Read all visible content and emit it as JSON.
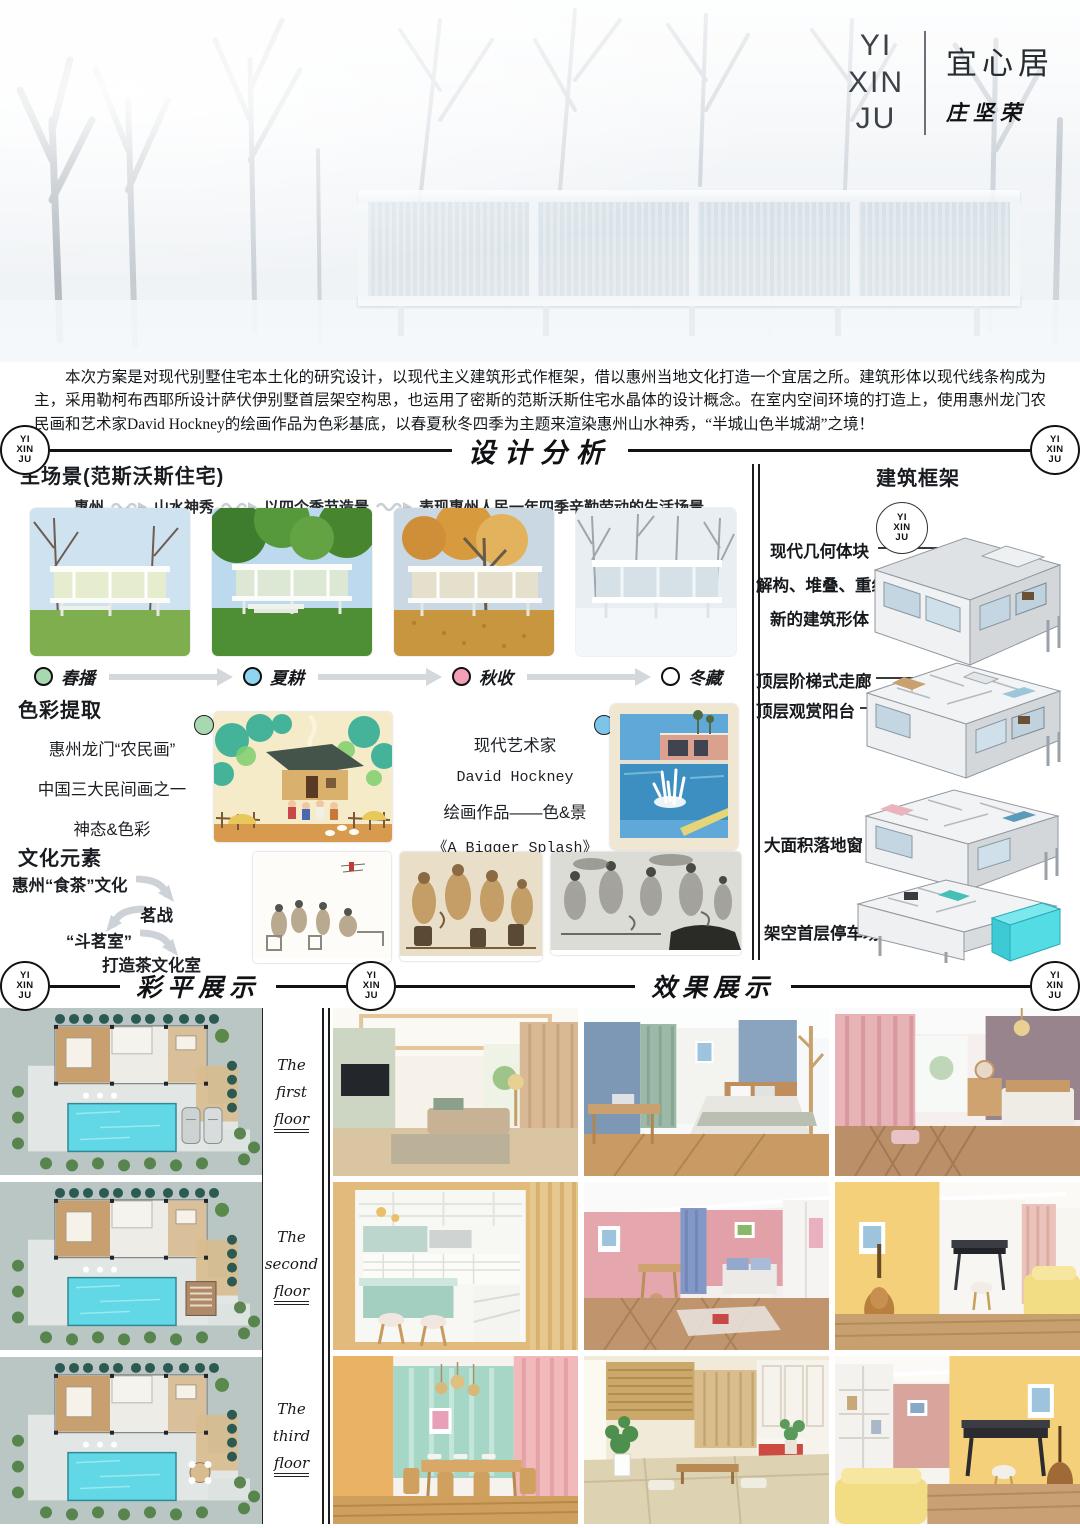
{
  "meta": {
    "logo": [
      "YI",
      "XIN",
      "JU"
    ],
    "title": "宜心居",
    "author": "庄坚荣"
  },
  "intro": {
    "text": "本次方案是对现代别墅住宅本土化的研究设计，以现代主义建筑形式作框架，借以惠州当地文化打造一个宜居之所。建筑形体以现代线条构成为主，采用勒柯布西耶所设计萨伏伊别墅首层架空构思，也运用了密斯的范斯沃斯住宅水晶体的设计概念。在室内空间环境的打造上，使用惠州龙门农民画和艺术家David Hockney的绘画作品为色彩基底，以春夏秋冬四季为主题来渲染惠州山水神秀，“半城山色半城湖”之境！"
  },
  "sections": {
    "analysis": "设计分析",
    "plans": "彩平展示",
    "renders": "效果展示"
  },
  "main_scene": {
    "heading": "主场景(范斯沃斯住宅)",
    "flow": [
      "惠州",
      "山水神秀",
      "以四个季节造景",
      "表现惠州人民一年四季辛勤劳动的生活场景"
    ],
    "seasons": [
      {
        "label": "春播",
        "color": "#a8d8b0"
      },
      {
        "label": "夏耕",
        "color": "#8fd4f0"
      },
      {
        "label": "秋收",
        "color": "#f2a0b8"
      },
      {
        "label": "冬藏",
        "color": "#ffffff"
      }
    ]
  },
  "color_extract": {
    "heading": "色彩提取",
    "folk": [
      "惠州龙门“农民画”",
      "中国三大民间画之一",
      "神态&色彩"
    ],
    "folk_dot_color": "#a8d8b0",
    "artist": [
      "现代艺术家",
      "David Hockney",
      "绘画作品——色&景",
      "《A Bigger Splash》"
    ],
    "artist_dot_color": "#7cc4e8"
  },
  "culture": {
    "heading": "文化元素",
    "steps": [
      "惠州“食茶”文化",
      "茗战",
      "“斗茗室”",
      "打造茶文化室"
    ]
  },
  "framework": {
    "heading": "建筑框架",
    "group1": [
      "现代几何体块",
      "解构、堆叠、重组",
      "新的建筑形体"
    ],
    "group2": [
      "顶层阶梯式走廊",
      "顶层观赏阳台"
    ],
    "label3": "大面积落地窗",
    "label4": "架空首层停车场",
    "parking_highlight_color": "#52dce4"
  },
  "floors": [
    [
      "The",
      "first",
      "floor"
    ],
    [
      "The",
      "second",
      "floor"
    ],
    [
      "The",
      "third",
      "floor"
    ]
  ]
}
